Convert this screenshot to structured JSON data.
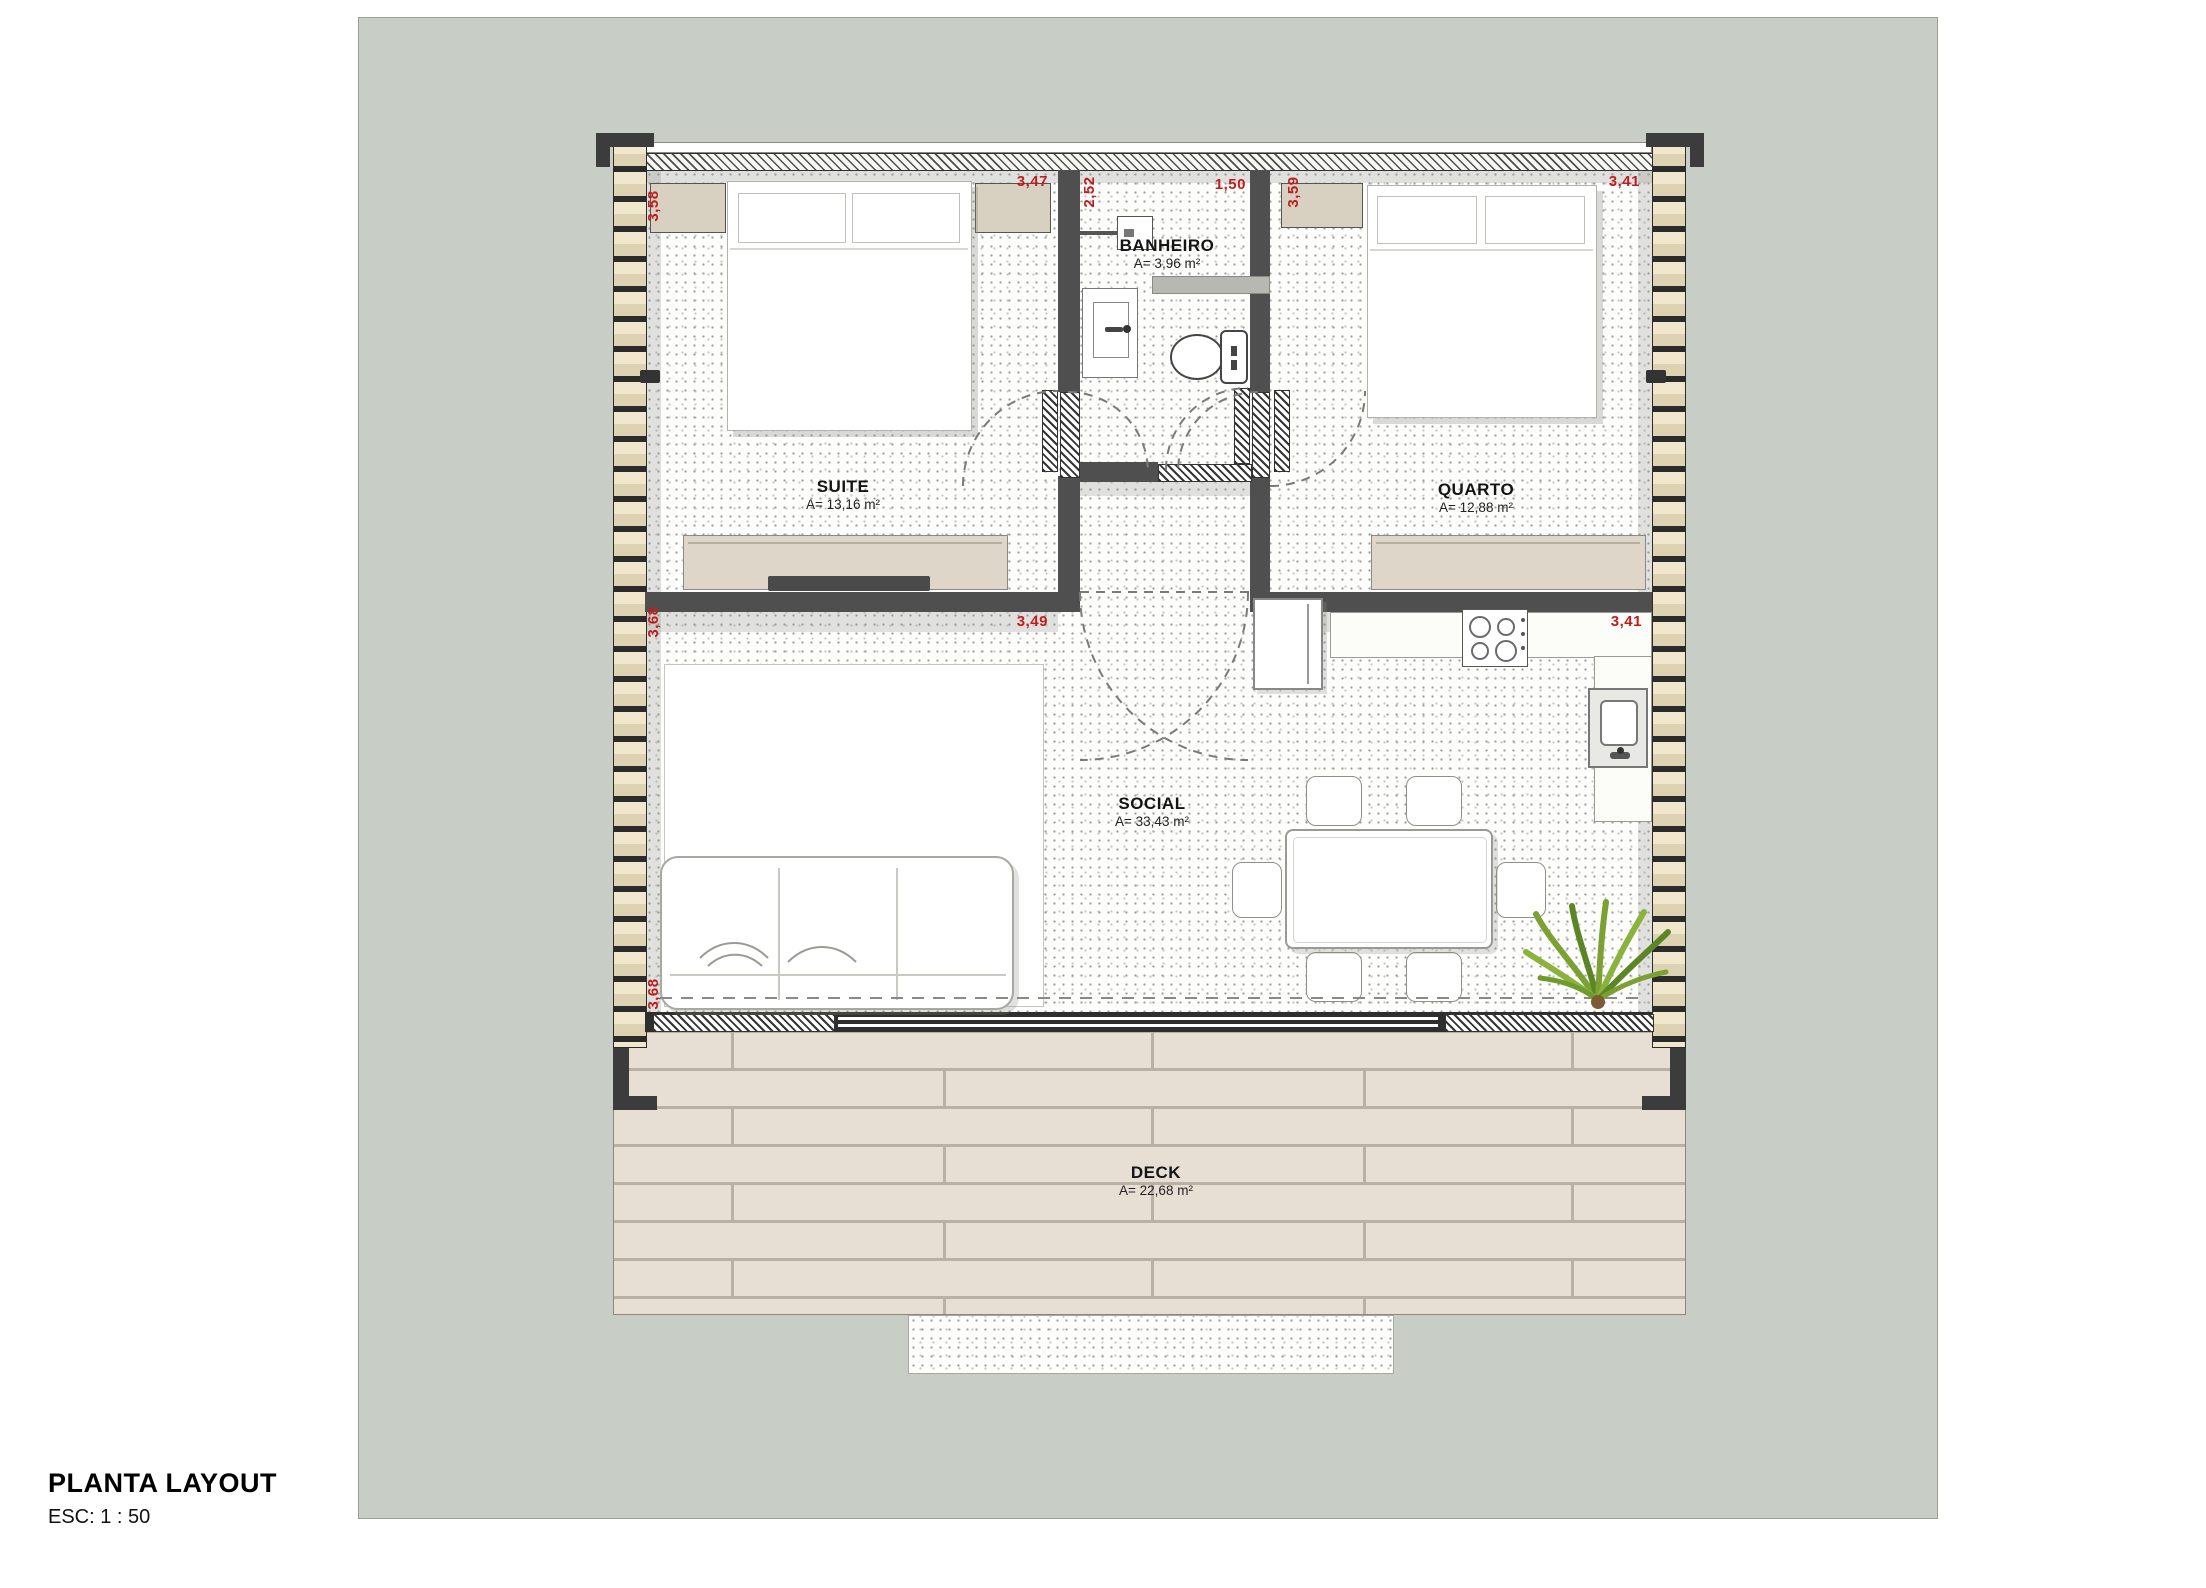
{
  "title_block": {
    "title": "PLANTA LAYOUT",
    "scale": "ESC: 1 : 50"
  },
  "rooms": {
    "suite": {
      "name": "SUITE",
      "area": "A= 13,16 m²"
    },
    "banheiro": {
      "name": "BANHEIRO",
      "area": "A= 3,96 m²"
    },
    "quarto": {
      "name": "QUARTO",
      "area": "A= 12,88 m²"
    },
    "social": {
      "name": "SOCIAL",
      "area": "A= 33,43 m²"
    },
    "deck": {
      "name": "DECK",
      "area": "A= 22,68 m²"
    }
  },
  "dimensions": {
    "suite_left": "3,58",
    "suite_top": "3,47",
    "banheiro_left": "2,52",
    "banheiro_top": "1,50",
    "quarto_left": "3,59",
    "quarto_top": "3,41",
    "social_left_upper": "3,68",
    "social_top_left": "3,49",
    "social_top_right": "3,41",
    "social_left_lower": "3,68"
  },
  "colors": {
    "background_panel": "#c8cec5",
    "dimension_red": "#bf1d1d",
    "wall_dark": "#4f4f4f",
    "timber_log": "#ece3c9",
    "furniture_beige": "#d8d0c0",
    "plant_green": "#7aa132"
  }
}
